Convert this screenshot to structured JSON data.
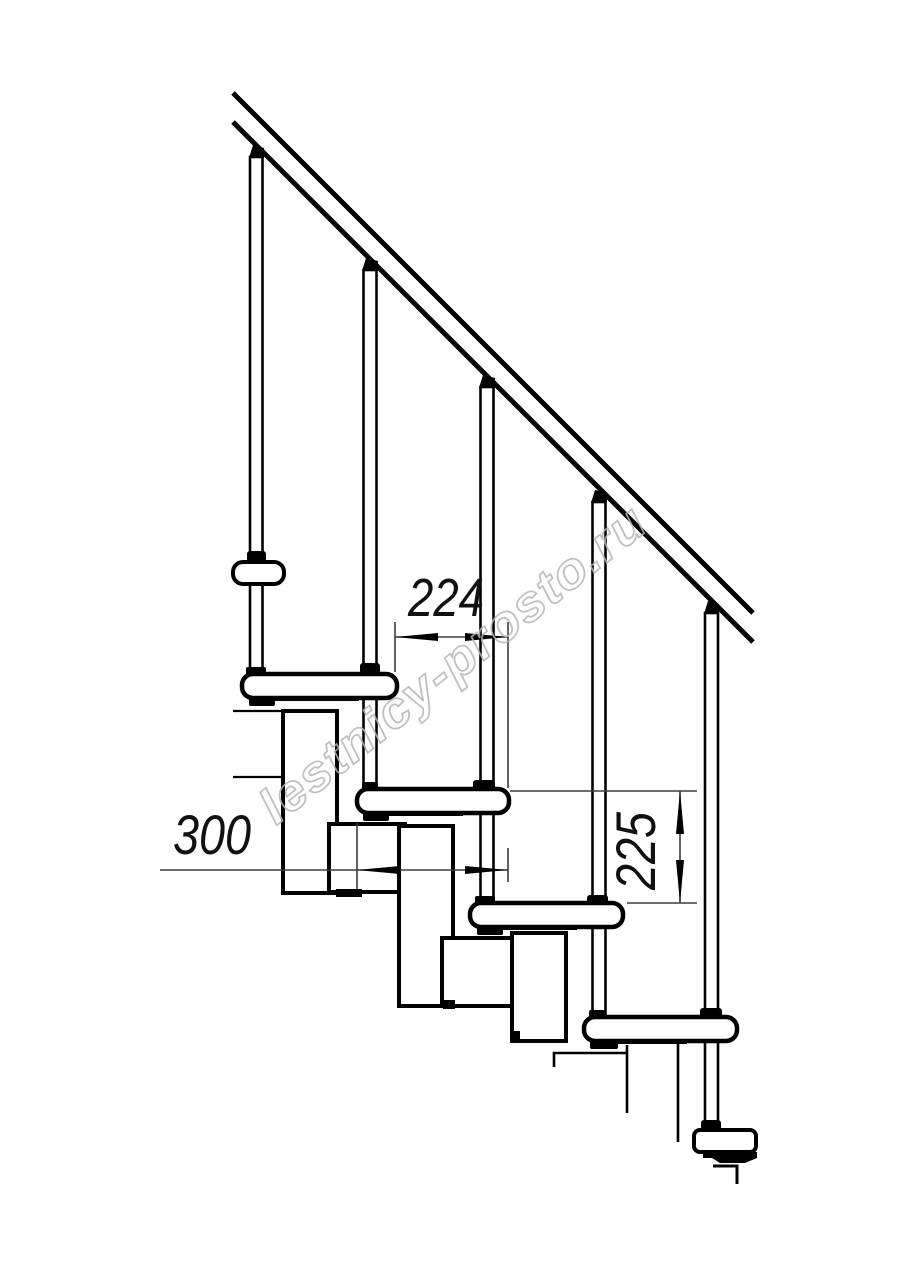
{
  "drawing": {
    "kind": "modular-staircase-side-view",
    "dimensions": {
      "going_label": "224",
      "tread_depth_label": "300",
      "rise_label": "225"
    },
    "watermark": {
      "text": "lestnicy-prosto.ru"
    },
    "colors": {
      "background": "#ffffff",
      "line": "#000000",
      "dim_line": "#3d3d3d",
      "watermark": "#b5b5b5"
    }
  }
}
